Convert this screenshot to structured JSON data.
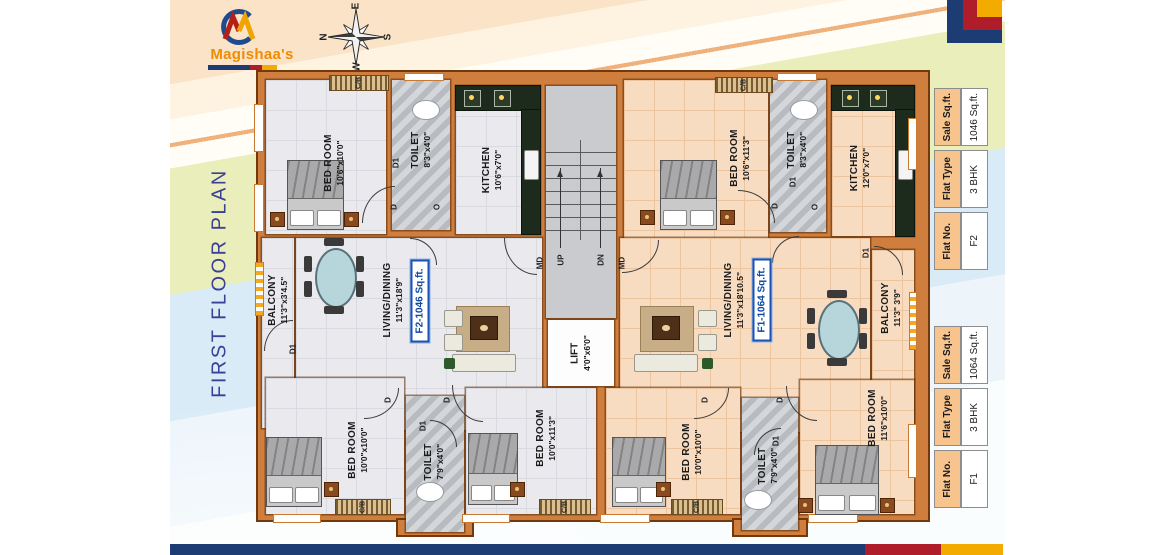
{
  "brand": {
    "name": "Magishaa's"
  },
  "title": "FIRST FLOOR PLAN",
  "compass": {
    "n": "N",
    "e": "E",
    "s": "S",
    "w": "W"
  },
  "plan": {
    "rooms": {
      "f2_bed1": {
        "name": "BED ROOM",
        "dims": "10'6\"x10'0\""
      },
      "f2_toilet1": {
        "name": "TOILET",
        "dims": "8'3\"x4'0\""
      },
      "f2_kitchen": {
        "name": "KITCHEN",
        "dims": "10'6\"x7'0\""
      },
      "f2_balcony": {
        "name": "BALCONY",
        "dims": "11'3\"x3'4.5\""
      },
      "f2_living": {
        "name": "LIVING/DINING",
        "dims": "11'3\"x18'9\""
      },
      "f2_bed2": {
        "name": "BED ROOM",
        "dims": "10'0\"x10'0\""
      },
      "f2_toilet2": {
        "name": "TOILET",
        "dims": "7'9\"x4'0\""
      },
      "f2_bed3": {
        "name": "BED ROOM",
        "dims": "10'0\"x11'3\""
      },
      "f1_bed1": {
        "name": "BED ROOM",
        "dims": "10'6\"x11'3\""
      },
      "f1_toilet1": {
        "name": "TOILET",
        "dims": "8'3\"x4'0\""
      },
      "f1_kitchen": {
        "name": "KITCHEN",
        "dims": "12'0\"x7'0\""
      },
      "f1_living": {
        "name": "LIVING/DINING",
        "dims": "11'3\"x18'10.5\""
      },
      "f1_balcony": {
        "name": "BALCONY",
        "dims": "11'3\" 3'9\""
      },
      "f1_bed2": {
        "name": "BED ROOM",
        "dims": "10'0\"x10'0\""
      },
      "f1_toilet2": {
        "name": "TOILET",
        "dims": "7'9\"x4'0\""
      },
      "f1_bed3": {
        "name": "BED ROOM",
        "dims": "11'6\"x10'0\""
      }
    },
    "core": {
      "lift_name": "LIFT",
      "lift_dims": "4'0\"x6'0\"",
      "up": "UP",
      "dn": "DN"
    },
    "markers": {
      "d": "D",
      "d1": "D1",
      "md": "MD",
      "cb": "C/B",
      "o": "O"
    },
    "flat_tags": {
      "f2": "F2-1046 Sq.ft.",
      "f1": "F1-1064 Sq.ft."
    }
  },
  "tables": [
    {
      "rows": [
        {
          "h": "Sale Sq.ft.",
          "v": "1046 Sq.ft."
        },
        {
          "h": "Flat Type",
          "v": "3 BHK"
        },
        {
          "h": "Flat No.",
          "v": "F2"
        }
      ]
    },
    {
      "rows": [
        {
          "h": "Sale Sq.ft.",
          "v": "1064 Sq.ft."
        },
        {
          "h": "Flat Type",
          "v": "3 BHK"
        },
        {
          "h": "Flat No.",
          "v": "F1"
        }
      ]
    }
  ],
  "colors": {
    "accent_blue": "#1d3c74",
    "accent_red": "#b01d2a",
    "accent_yellow": "#f3ab00",
    "wall_orange": "#cf7e3e",
    "tag_blue": "#1c53b0",
    "title_blue": "#3b3f95",
    "brand_orange": "#ef8c05"
  }
}
